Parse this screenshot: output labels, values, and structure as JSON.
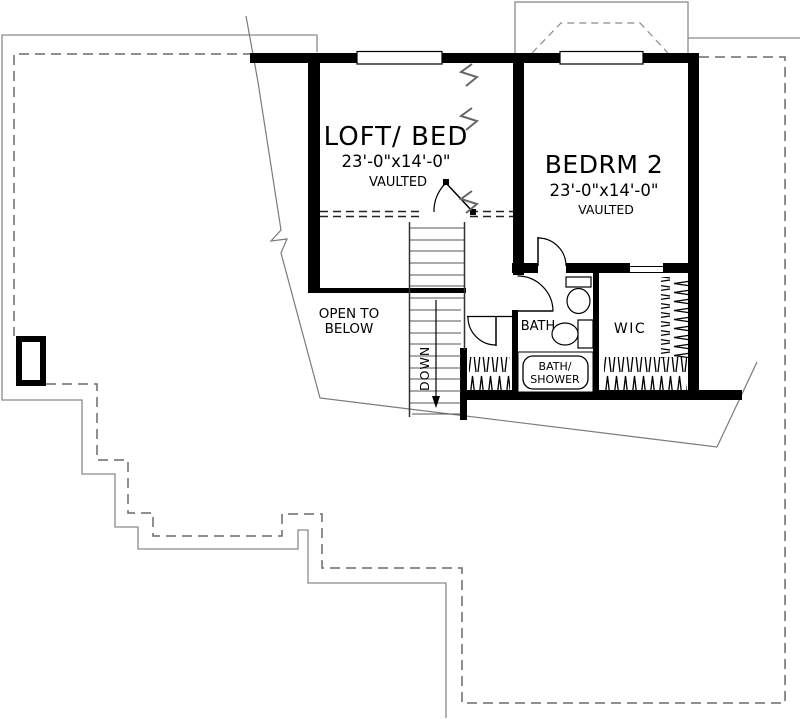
{
  "plan": {
    "rooms": {
      "loft": {
        "name": "LOFT/ BED",
        "dims": "23'-0\"x14'-0\"",
        "note": "VAULTED"
      },
      "bedroom2": {
        "name": "BEDRM 2",
        "dims": "23'-0\"x14'-0\"",
        "note": "VAULTED"
      },
      "bath": {
        "name": "BATH"
      },
      "wic": {
        "name": "WIC"
      }
    },
    "annotations": {
      "open_below_1": "OPEN TO",
      "open_below_2": "BELOW",
      "stair_direction": "DOWN",
      "tub_1": "BATH/",
      "tub_2": "SHOWER"
    },
    "colors": {
      "wall": "#000000",
      "roof_line": "#8a8a8a",
      "footprint_dash": "#6a6a6a",
      "background": "#ffffff"
    }
  }
}
